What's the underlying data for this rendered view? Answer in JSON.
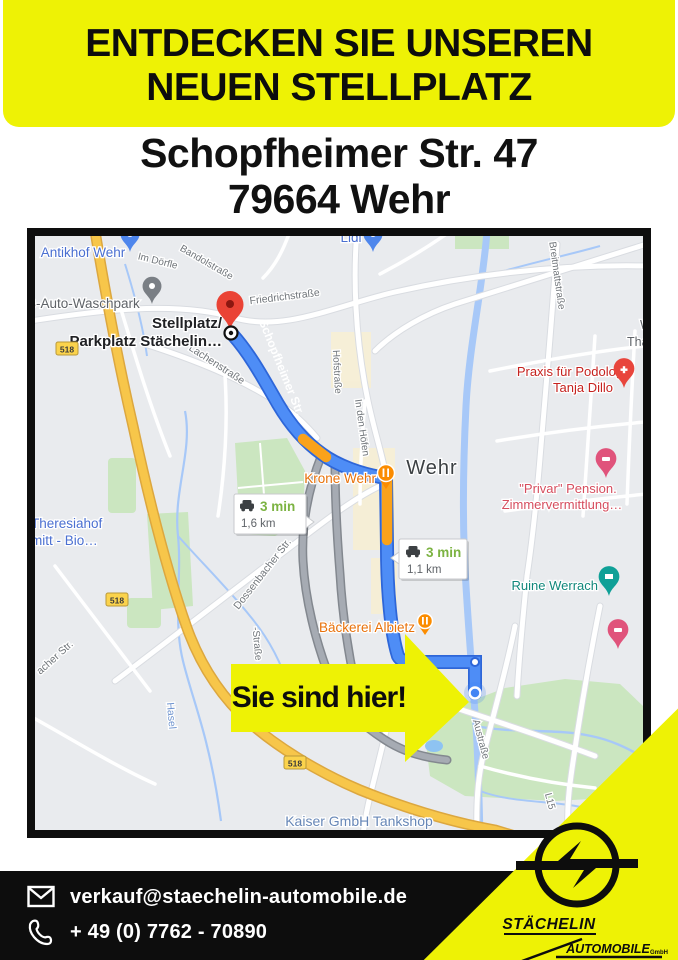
{
  "header": {
    "line1": "ENTDECKEN SIE UNSEREN",
    "line2": "NEUEN STELLPLATZ"
  },
  "address": {
    "line1": "Schopfheimer Str. 47",
    "line2": "79664 Wehr"
  },
  "callout": {
    "text": "Sie sind hier!"
  },
  "footer": {
    "email": "verkauf@staechelin-automobile.de",
    "phone": "+ 49 (0) 7762 - 70890"
  },
  "logo": {
    "name": "STÄCHELIN",
    "line2": "AUTOMOBILE",
    "suffix": "GmbH"
  },
  "colors": {
    "accent_yellow": "#eef205",
    "route_blue": "#4e8df6",
    "route_orange": "#faa21b",
    "footer_black": "#0d0d0d"
  },
  "map": {
    "city": "Wehr",
    "road_badge": "518",
    "bubbles": [
      {
        "time": "3 min",
        "dist": "1,6 km"
      },
      {
        "time": "3 min",
        "dist": "1,1 km"
      }
    ],
    "labels": {
      "antikhof": "Antikhof Wehr",
      "lidl": "Lidl",
      "waschpark": "B-Auto-Waschpark",
      "stellplatz1": "Stellplatz/",
      "stellplatz2": "Parkplatz Stächelin…",
      "friedrich": "Friedrichstraße",
      "bandol": "Bandolstraße",
      "doerfle": "Im Dörfle",
      "lachen": "Lachenstraße",
      "hofstrasse": "Hofstraße",
      "schopfheimer": "Schopfheimer Str.",
      "breitmatt": "Breitmattstraße",
      "thai1": "We",
      "thai2": "Thai Ma",
      "praxis1": "Praxis für Podologie",
      "praxis2": "Tanja Dillo",
      "krone": "Krone Wehr",
      "privar1": "\"Privar\" Pension.",
      "privar2": "Zimmervermittlung…",
      "ruine": "Ruine Werrach",
      "baeckerei": "Bäckerei Albietz",
      "dossenbacher": "Dossenbacher Str.",
      "bacher": "acher Str.",
      "theresia1": "Theresiahof",
      "theresia2": "mitt - Bio…",
      "hasel": "Hasel",
      "strasse2": "-Straße",
      "indenhoefen": "In den Höfen",
      "austrasse": "Austraße",
      "l15": "L15",
      "kaiser": "Kaiser GmbH Tankshop"
    }
  }
}
